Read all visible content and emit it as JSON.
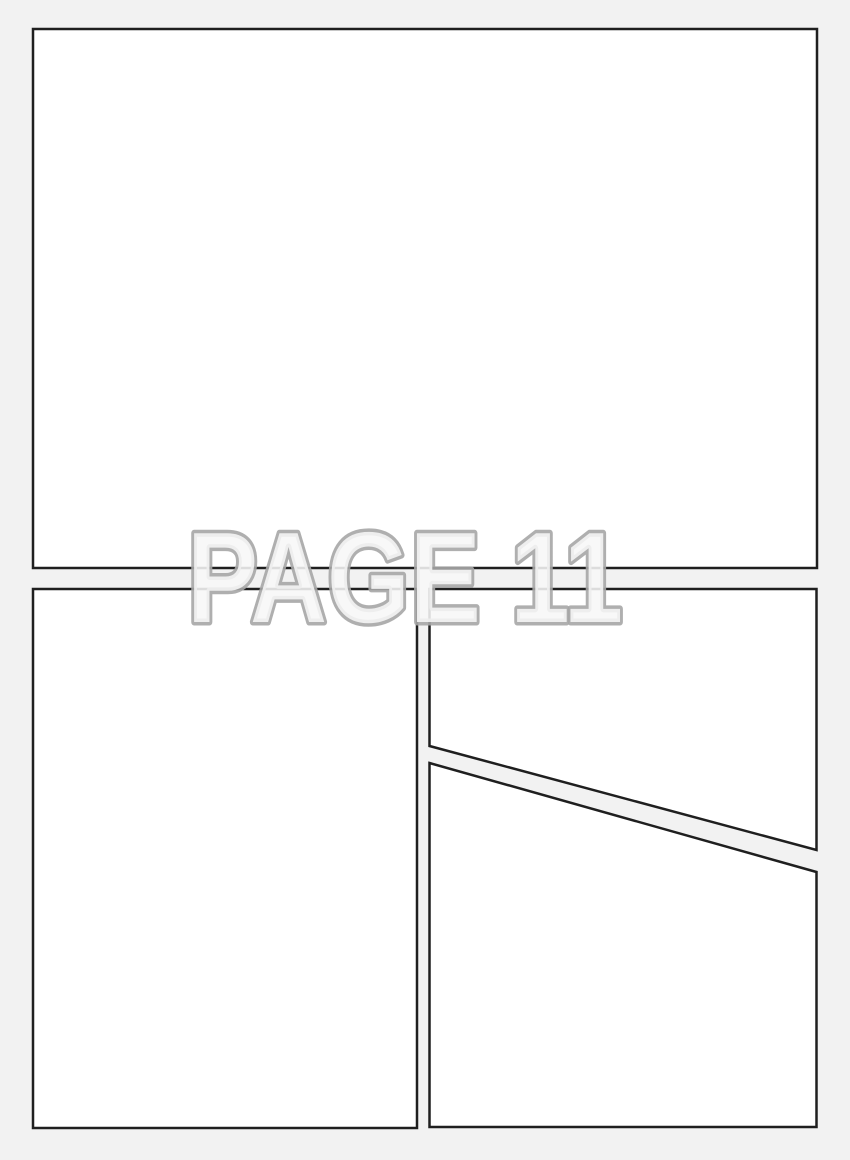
{
  "page": {
    "label": "PAGE 11"
  },
  "panels": [
    {
      "name": "top-panel"
    },
    {
      "name": "bottom-left-panel"
    },
    {
      "name": "right-upper-panel"
    },
    {
      "name": "right-lower-panel"
    }
  ],
  "colors": {
    "background": "#f2f2f2",
    "panel_fill": "#ffffff",
    "panel_border": "#1f1f1f",
    "watermark_fill": "#f7f7f7",
    "watermark_outline": "#a6a6a6"
  }
}
